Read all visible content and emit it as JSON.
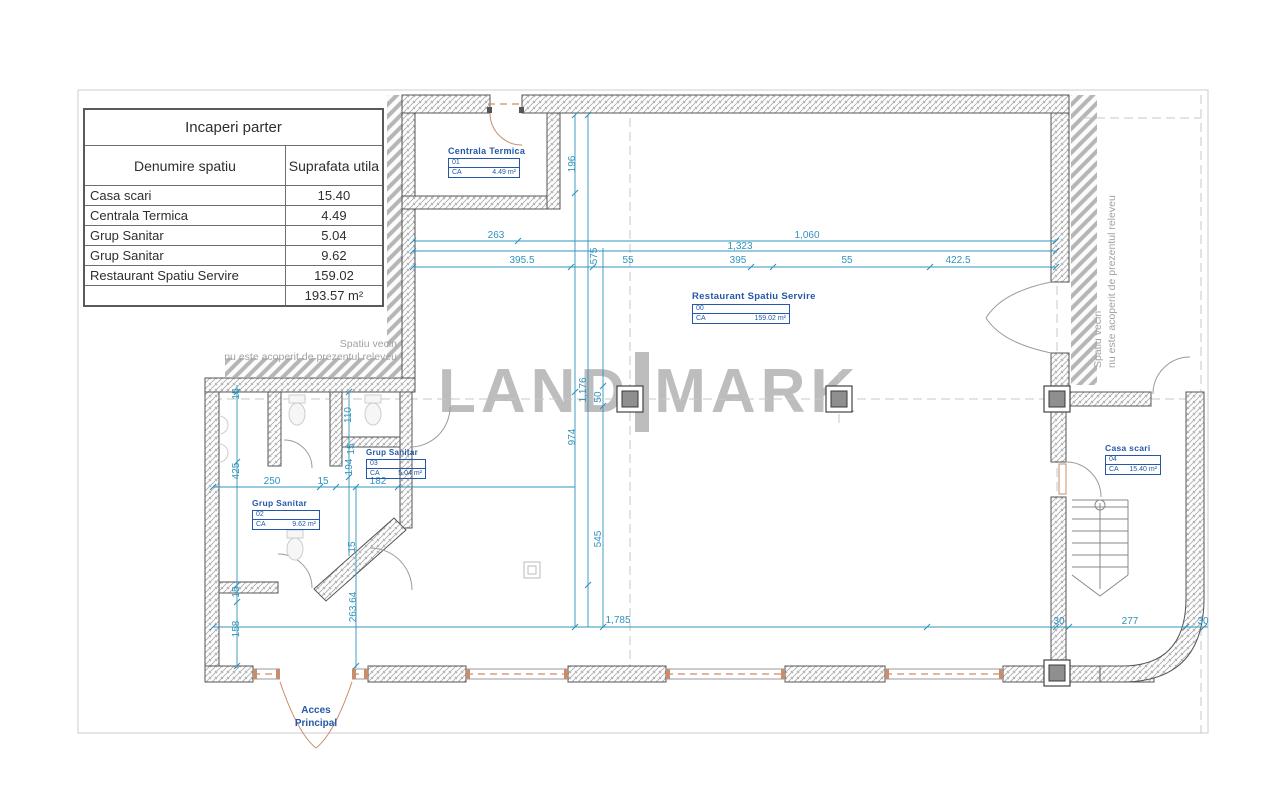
{
  "table": {
    "title": "Incaperi parter",
    "col_name": "Denumire spatiu",
    "col_area": "Suprafata utila",
    "rows": [
      {
        "name": "Casa scari",
        "area": "15.40"
      },
      {
        "name": "Centrala Termica",
        "area": "4.49"
      },
      {
        "name": "Grup Sanitar",
        "area": "5.04"
      },
      {
        "name": "Grup Sanitar",
        "area": "9.62"
      },
      {
        "name": "Restaurant Spatiu Servire",
        "area": "159.02"
      }
    ],
    "total": "193.57 m²"
  },
  "watermark": {
    "left": "LAND",
    "right": "MARK"
  },
  "rooms": {
    "centrala": {
      "title": "Centrala Termica",
      "num": "01",
      "ca": "CA",
      "area": "4.49 m²"
    },
    "restaurant": {
      "title": "Restaurant Spatiu Servire",
      "num": "00",
      "ca": "CA",
      "area": "159.02 m²"
    },
    "gs03": {
      "title": "Grup Sanitar",
      "num": "03",
      "ca": "CA",
      "area": "5.04 m²"
    },
    "gs02": {
      "title": "Grup Sanitar",
      "num": "02",
      "ca": "CA",
      "area": "9.62 m²"
    },
    "casa": {
      "title": "Casa scari",
      "num": "04",
      "ca": "CA",
      "area": "15.40 m²"
    }
  },
  "notes": {
    "left1": "Spatiu vecin",
    "left2": "nu este acoperit de prezentul releveu",
    "right1": "Spatiu vecin",
    "right2": "nu este acoperit de prezentul releveu"
  },
  "entrance": {
    "line1": "Acces",
    "line2": "Principal"
  },
  "dims": [
    "263",
    "1,060",
    "1,323",
    "395.5",
    "575",
    "55",
    "395",
    "55",
    "422.5",
    "196",
    "1,176",
    "50",
    "974",
    "545",
    "1,785",
    "30",
    "277",
    "30",
    "15",
    "425",
    "110",
    "15",
    "194",
    "250",
    "15",
    "182",
    "15",
    "15",
    "158",
    "263.64"
  ],
  "colors": {
    "dim_blue": "#3093bd",
    "label_blue": "#2458a6",
    "wall_line": "#555555",
    "hatch_gray": "#b3b3b3",
    "watermark_gray": "#bdbdbd",
    "door_orange": "#c98d6b",
    "frame_gray": "#cccccc",
    "table_text": "#2e2e2e"
  }
}
